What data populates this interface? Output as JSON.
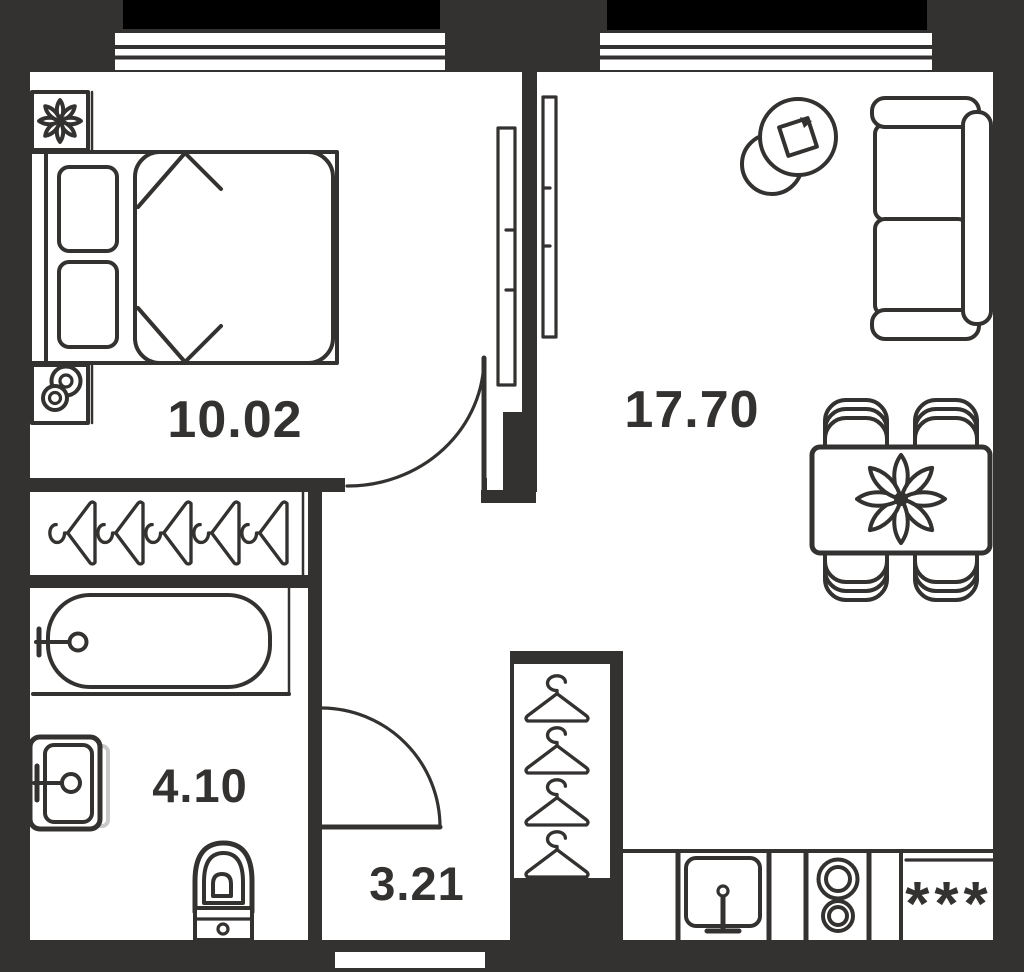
{
  "plan": {
    "type": "apartment-floor-plan",
    "rooms": [
      {
        "name": "bedroom",
        "area": "10.02"
      },
      {
        "name": "living-kitchen",
        "area": "17.70"
      },
      {
        "name": "bathroom",
        "area": "4.10"
      },
      {
        "name": "hallway",
        "area": "3.21"
      }
    ],
    "kitchen": {
      "fridge_symbol": "***"
    },
    "colors": {
      "wall": "#343230",
      "floor": "#ffffff",
      "balcony": "#000000",
      "ghost": "#c9c9c9",
      "text": "#343230"
    },
    "furniture": [
      "double-bed",
      "pillows",
      "plant-nightstand",
      "lamp-nightstand",
      "coat-rack-5-hangers",
      "bathtub",
      "wash-basin",
      "toilet",
      "hall-closet-4-hangers",
      "sofa",
      "pouf-side-table",
      "dining-table-4-chairs",
      "flower-centerpiece",
      "kitchen-sink",
      "stove-2-burners",
      "fridge",
      "balcony-left",
      "balcony-right",
      "window-left",
      "window-right"
    ]
  }
}
